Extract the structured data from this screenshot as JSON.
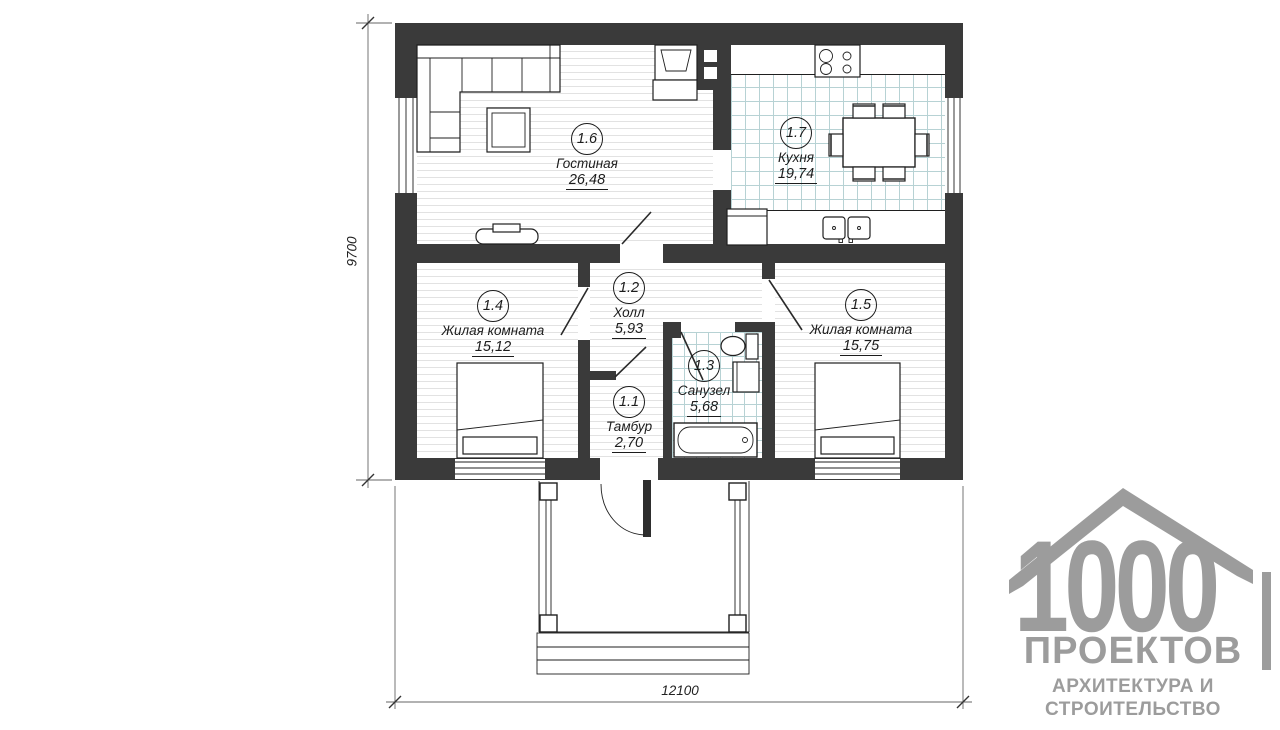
{
  "rooms": [
    {
      "num": "1.6",
      "name": "Гостиная",
      "area": "26,48"
    },
    {
      "num": "1.7",
      "name": "Кухня",
      "area": "19,74"
    },
    {
      "num": "1.4",
      "name": "Жилая комната",
      "area": "15,12"
    },
    {
      "num": "1.2",
      "name": "Холл",
      "area": "5,93"
    },
    {
      "num": "1.3",
      "name": "Санузел",
      "area": "5,68"
    },
    {
      "num": "1.1",
      "name": "Тамбур",
      "area": "2,70"
    },
    {
      "num": "1.5",
      "name": "Жилая комната",
      "area": "15,75"
    }
  ],
  "dimensions": {
    "height_label": "9700",
    "width_label": "12100"
  },
  "logo": {
    "number": "1000",
    "name": "ПРОЕКТОВ",
    "tagline_line1": "АРХИТЕКТУРА И",
    "tagline_line2": "СТРОИТЕЛЬСТВО"
  },
  "colors": {
    "wall": "#3a3a3a",
    "line": "#1f1f1f",
    "tile_line": "#b7d2d4",
    "wood_line": "#e2e2e2",
    "logo_gray": "#9c9c9c"
  }
}
